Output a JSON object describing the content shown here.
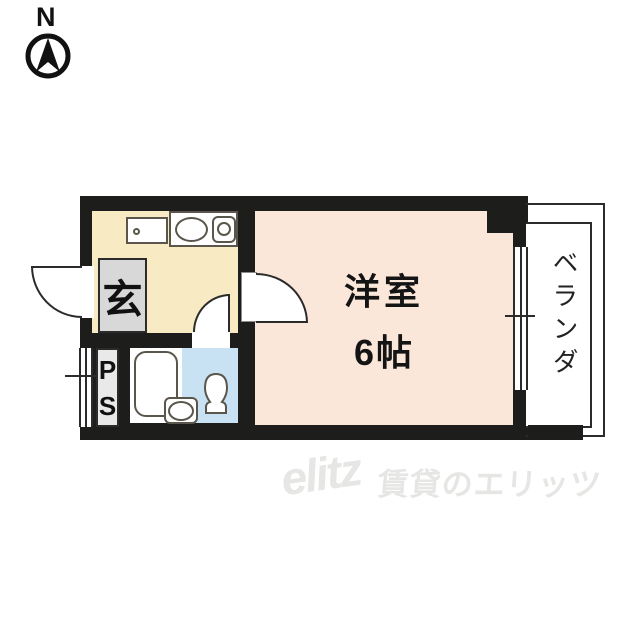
{
  "compass": {
    "north_label": "N",
    "icon": "north-compass-icon"
  },
  "floorplan": {
    "entrance": {
      "label": "玄"
    },
    "pipe_space": {
      "p": "P",
      "s": "S"
    },
    "room": {
      "name": "洋室",
      "size": "6帖"
    },
    "balcony": {
      "label": "ベランダ"
    },
    "fixtures": {
      "kitchen_counter": "counter-with-faucet",
      "kitchen_sink": "oval-sink",
      "stove": "single-burner",
      "bathtub": "bathtub",
      "washbasin": "washbasin",
      "toilet": "toilet",
      "entrance_door": "swing-door-out",
      "room_door": "swing-door-in",
      "bath_door": "swing-door-in",
      "windows": "double-sliding-window"
    },
    "colors": {
      "wall": "#1D1D1B",
      "kitchen": "#F8EBC3",
      "main_room": "#FBE7D9",
      "toilet_room": "#C8E2F4",
      "entrance": "#D8D8D8",
      "pipe_space": "#E9E9E9",
      "line": "#2B2B2B"
    }
  },
  "watermark": {
    "logo": "elitz",
    "text": "賃貸のエリッツ",
    "color": "#E6E6E4"
  }
}
